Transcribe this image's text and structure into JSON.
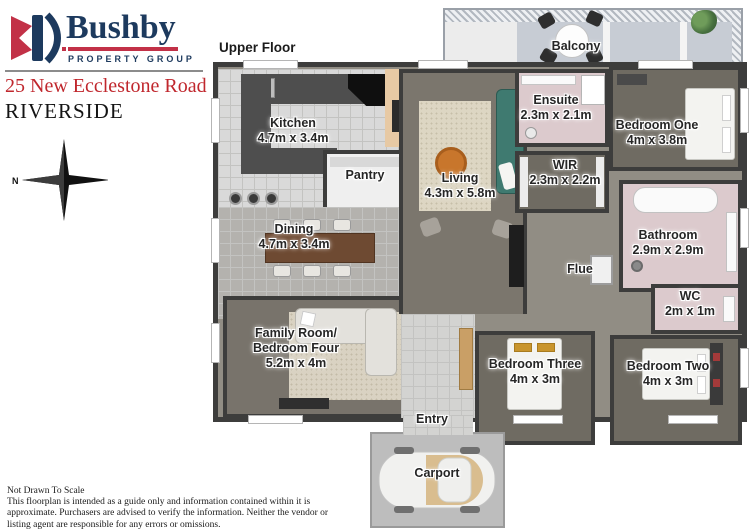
{
  "brand": {
    "logo_text": "Bushby",
    "logo_tagline": "PROPERTY GROUP"
  },
  "listing": {
    "address": "25 New Ecclestone Road",
    "suburb": "RIVERSIDE"
  },
  "compass": {
    "north_label": "N"
  },
  "plan": {
    "floor_label": "Upper Floor",
    "rooms": {
      "kitchen": {
        "name": "Kitchen",
        "dims": "4.7m x 3.4m"
      },
      "pantry": {
        "name": "Pantry"
      },
      "dining": {
        "name": "Dining",
        "dims": "4.7m x 3.4m"
      },
      "family_room": {
        "name_line1": "Family Room/",
        "name_line2": "Bedroom Four",
        "dims": "5.2m x 4m"
      },
      "living": {
        "name": "Living",
        "dims": "4.3m x 5.8m"
      },
      "balcony": {
        "name": "Balcony"
      },
      "ensuite": {
        "name": "Ensuite",
        "dims": "2.3m x 2.1m"
      },
      "wir": {
        "name": "WIR",
        "dims": "2.3m x 2.2m"
      },
      "bedroom_one": {
        "name": "Bedroom One",
        "dims": "4m x 3.8m"
      },
      "bathroom": {
        "name": "Bathroom",
        "dims": "2.9m x 2.9m"
      },
      "wc": {
        "name": "WC",
        "dims": "2m x 1m"
      },
      "flue": {
        "name": "Flue"
      },
      "bedroom_three": {
        "name": "Bedroom Three",
        "dims": "4m x 3m"
      },
      "bedroom_two": {
        "name": "Bedroom Two",
        "dims": "4m x 3m"
      },
      "entry": {
        "name": "Entry"
      },
      "carport": {
        "name": "Carport"
      }
    }
  },
  "footer": {
    "scale_note": "Not Drawn To Scale",
    "disclaimer": "This floorplan is intended as a guide only and information contained within it is approximate. Purchasers are advised to verify the information. Neither the vendor or listing agent are responsible for any errors or omissions."
  },
  "colors": {
    "brand_navy": "#1d3a5e",
    "brand_red": "#c23147",
    "address_red": "#c0272d",
    "wall": "#3d3d3c",
    "bedroom_floor": "#6f6b62",
    "living_floor": "#7b766d",
    "wet_area_pink": "#dccacd",
    "kitchen_floor": "#d9d9d9",
    "balcony_floor": "#c7ccd4",
    "sofa_teal": "#3f7a70",
    "coffee_table_orange": "#c8762c"
  }
}
